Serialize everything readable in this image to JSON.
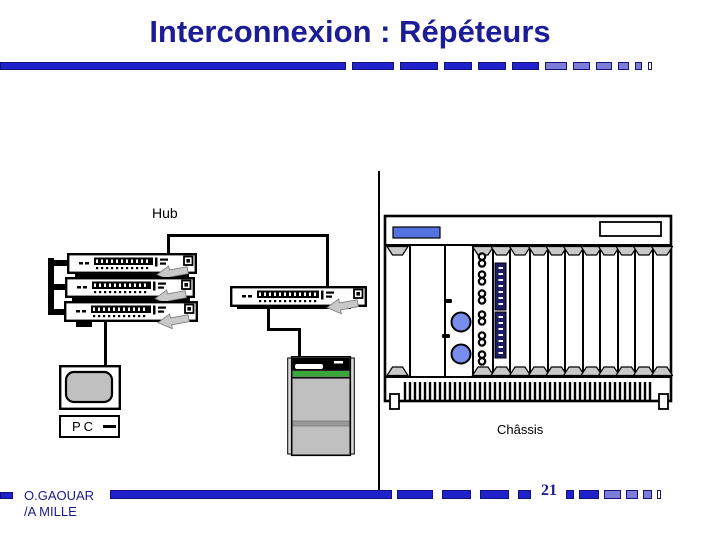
{
  "slide": {
    "title": "Interconnexion : Répéteurs",
    "page_number": "21",
    "footer_line1": "O.GAOUAR",
    "footer_line2": "/A MILLE"
  },
  "diagram": {
    "hub_label": "Hub",
    "pc_label": "PC",
    "server_label": "Serveur",
    "chassis_label": "Châssis",
    "slot_pont": "PONT",
    "slot_adm": "ADM"
  },
  "colors": {
    "title_navy": "#1c1c99",
    "bar_blue": "#2121cc",
    "bar_light_blue": "#7d7dd8",
    "bar_border_navy": "#12127a",
    "device_gray": "#c0c0c0",
    "trapezoid_gray": "#c9c9c9",
    "server_green": "#3aa53a",
    "led_blue": "#7a8cec",
    "chassis_display_blue": "#5573e0",
    "dip_navy": "#1b1b66"
  },
  "decor": {
    "top_segments": [
      {
        "w": 42,
        "t": "solid"
      },
      {
        "w": 38,
        "t": "solid"
      },
      {
        "w": 28,
        "t": "solid"
      },
      {
        "w": 28,
        "t": "solid"
      },
      {
        "w": 27,
        "t": "solid"
      },
      {
        "w": 22,
        "t": "light"
      },
      {
        "w": 17,
        "t": "light"
      },
      {
        "w": 16,
        "t": "light"
      },
      {
        "w": 11,
        "t": "light"
      },
      {
        "w": 7,
        "t": "light"
      },
      {
        "w": 4,
        "t": "outline"
      }
    ],
    "bottom_segments_pre": [
      {
        "w": 36,
        "t": "solid"
      },
      {
        "w": 29,
        "t": "solid"
      },
      {
        "w": 29,
        "t": "solid"
      },
      {
        "w": 13,
        "t": "solid"
      }
    ],
    "bottom_segments_post": [
      {
        "w": 8,
        "t": "solid"
      },
      {
        "w": 20,
        "t": "solid"
      },
      {
        "w": 17,
        "t": "light"
      },
      {
        "w": 12,
        "t": "light"
      },
      {
        "w": 9,
        "t": "light"
      },
      {
        "w": 4,
        "t": "outline"
      }
    ]
  }
}
